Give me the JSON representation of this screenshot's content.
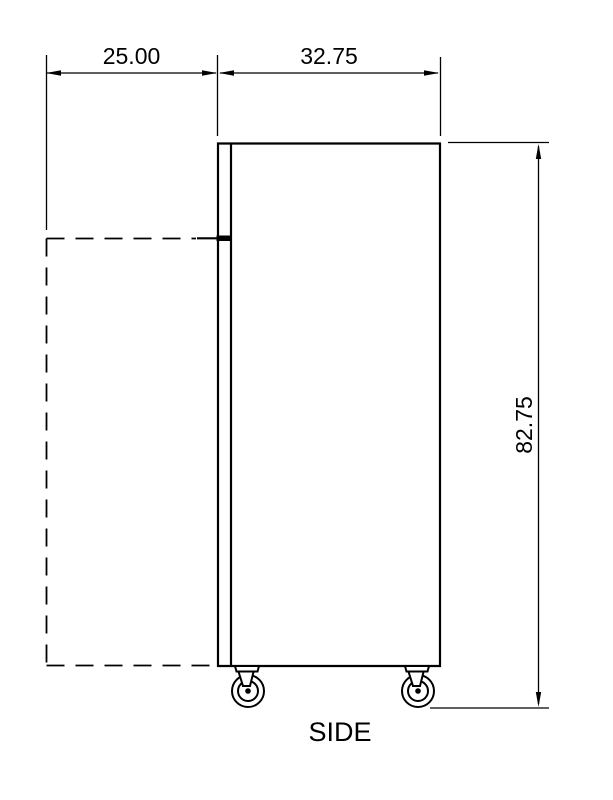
{
  "drawing": {
    "view_label": "SIDE",
    "dimensions": {
      "door_swing_depth": "25.00",
      "cabinet_depth": "32.75",
      "overall_height": "82.75"
    }
  },
  "colors": {
    "line": "#000000",
    "background": "#ffffff"
  }
}
